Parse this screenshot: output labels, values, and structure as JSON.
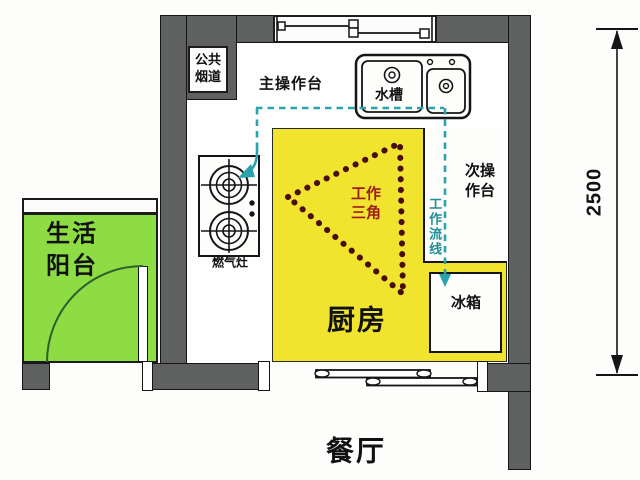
{
  "diagram_type": "kitchen-floor-plan",
  "rooms": {
    "kitchen": {
      "label": "厨房"
    },
    "dining": {
      "label": "餐厅"
    },
    "balcony": {
      "label_lines": [
        "生活",
        "阳台"
      ]
    }
  },
  "fixtures": {
    "flue": {
      "label_lines": [
        "公共",
        "烟道"
      ]
    },
    "main_counter": {
      "label": "主操作台"
    },
    "sink": {
      "label": "水槽"
    },
    "secondary_counter": {
      "label_lines": [
        "次操",
        "作台"
      ]
    },
    "stove": {
      "label": "燃气灶"
    },
    "fridge": {
      "label": "冰箱"
    }
  },
  "annotations": {
    "work_triangle": {
      "label_lines": [
        "工作",
        "三角"
      ]
    },
    "work_flow": {
      "label": "工作流线"
    },
    "dimension": {
      "value": "2500"
    }
  },
  "colors": {
    "wall": "#5f6060",
    "kitchen_floor": "#f1e42f",
    "balcony_floor": "#8edc43",
    "flow_line": "#29a4ac",
    "triangle": "#4a0d0d",
    "triangle_text": "#9e1b1b",
    "outline": "#151515"
  }
}
